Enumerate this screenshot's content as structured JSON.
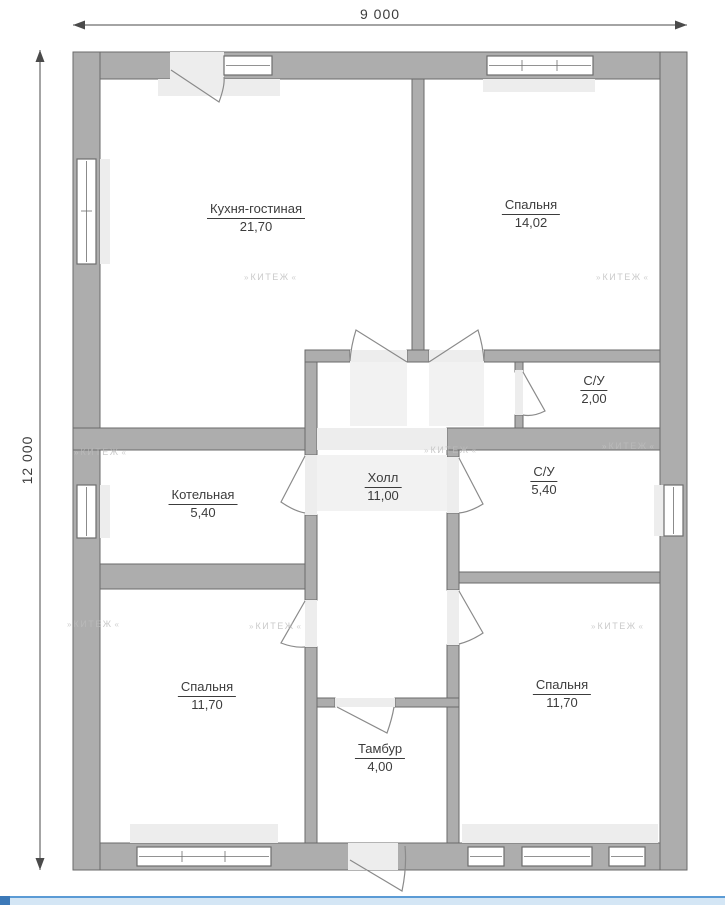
{
  "plan": {
    "dimension_width_label": "9 000",
    "dimension_height_label": "12 000",
    "rooms": {
      "kitchen_living": {
        "name": "Кухня-гостиная",
        "area": "21,70"
      },
      "bedroom_top_right": {
        "name": "Спальня",
        "area": "14,02"
      },
      "wc_small": {
        "name": "С/У",
        "area": "2,00"
      },
      "boiler_room": {
        "name": "Котельная",
        "area": "5,40"
      },
      "hall": {
        "name": "Холл",
        "area": "11,00"
      },
      "wc_large": {
        "name": "С/У",
        "area": "5,40"
      },
      "bedroom_bottom_left": {
        "name": "Спальня",
        "area": "11,70"
      },
      "vestibule": {
        "name": "Тамбур",
        "area": "4,00"
      },
      "bedroom_bottom_right": {
        "name": "Спальня",
        "area": "11,70"
      }
    },
    "watermark": {
      "left_arrow": "»",
      "text": "КИТЕЖ",
      "right_arrow": "«"
    }
  },
  "colors": {
    "wall_fill": "#adadad",
    "wall_outline": "#6a6a6a",
    "scroll_track": "#d4e6f5",
    "scroll_accent": "#5b9bd5",
    "scroll_thumb": "#3c79b8"
  }
}
